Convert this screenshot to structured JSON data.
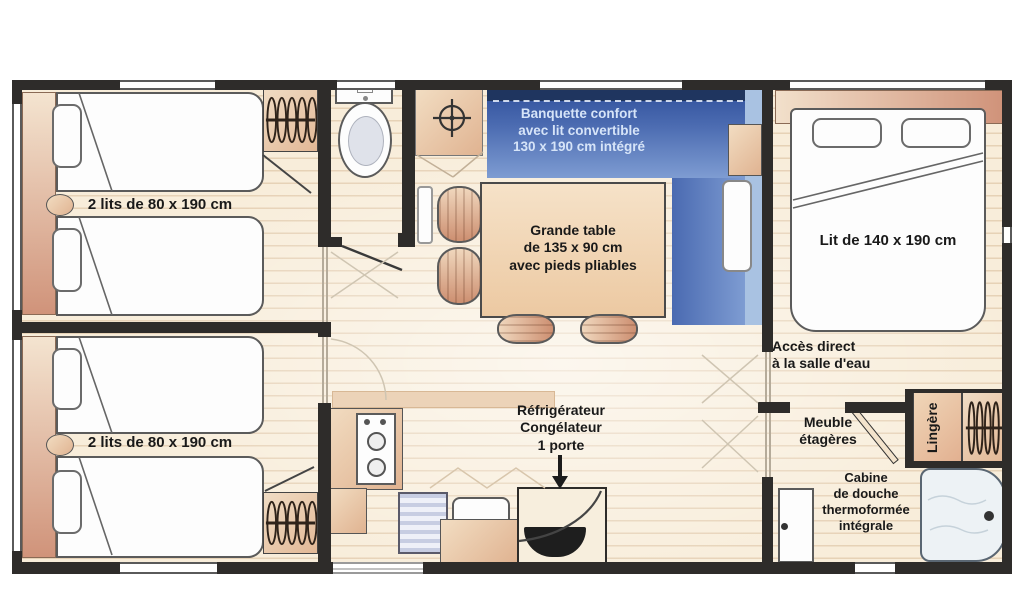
{
  "plan": {
    "bedroom_left_top": {
      "label": "2 lits de 80 x 190 cm"
    },
    "bedroom_left_bottom": {
      "label": "2 lits de 80 x 190 cm"
    },
    "living": {
      "banquette_label": "Banquette confort\navec lit convertible\n130 x 190 cm intégré",
      "table_label": "Grande table\nde 135 x 90 cm\navec pieds pliables"
    },
    "kitchen": {
      "fridge_label": "Réfrigérateur\nCongélateur\n1 porte"
    },
    "bedroom_right": {
      "bed_label": "Lit de 140 x 190 cm",
      "access_label": "Accès direct\nà la salle d'eau"
    },
    "bathroom": {
      "shelf_label": "Meuble\nétagères",
      "linen_label": "Lingère",
      "shower_label": "Cabine\nde douche\nthermoformée\nintégrale"
    }
  },
  "colors": {
    "wall": "#2e2c2a",
    "floor": "#f8edda",
    "furniture_tan": "#e0b391",
    "banquette_blue": "#4a6ab0",
    "banquette_dark": "#1f355f",
    "banquette_light": "#a9c2e2",
    "shower_tray": "#edf2f5",
    "label_text": "#191919",
    "banquette_text": "#d6e4f8"
  }
}
